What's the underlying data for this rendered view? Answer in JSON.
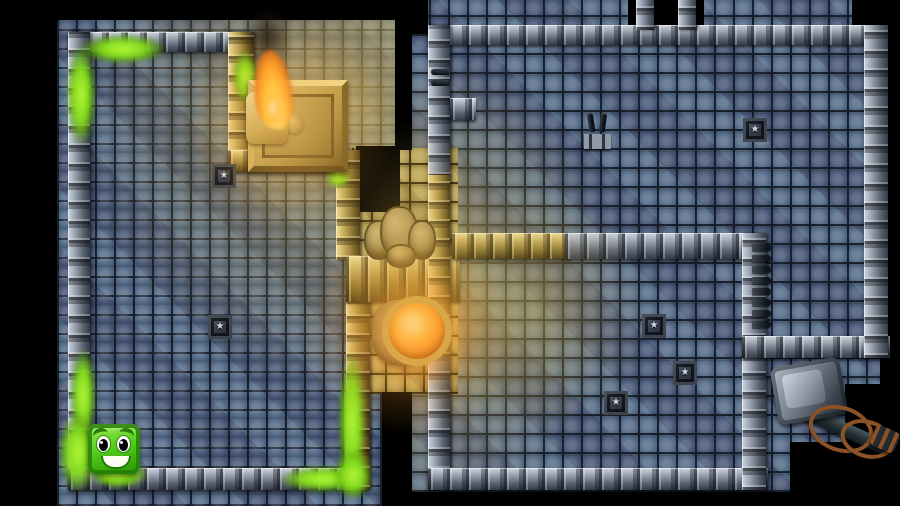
{
  "app": {
    "name": "Top-down dungeon puzzle game",
    "view": "level overview"
  },
  "entities": {
    "player": {
      "name": "Green slime cube hero",
      "color": "#4ec81a",
      "expression": "smiling"
    },
    "torch": {
      "name": "Lit torch on golden pedestal",
      "flame_color": "#ff9a22",
      "smoke": true
    },
    "beacon": {
      "name": "Glowing orange orb beacon",
      "color": "#ff8f1f",
      "ring_color": "#c2a452"
    },
    "rocks": {
      "name": "Boulder pile blocking corridor",
      "count": 4,
      "color": "#a48d54"
    },
    "hammer": {
      "name": "Giant sledgehammer with rope-bound handle",
      "head_color": "#77818d",
      "rope_color": "#8a5226"
    },
    "plates": {
      "name": "Star pressure plate",
      "glyph": "★",
      "count": 6,
      "color": "#3a4150"
    },
    "hook_traps": {
      "name": "Twin metal hook trap",
      "count": 2
    },
    "hook_row": {
      "name": "Row of wall hook pegs",
      "count": 8
    },
    "slime_trail": {
      "name": "Green slime trail",
      "color": "#84dc1e",
      "segments": 11
    }
  },
  "rooms": [
    {
      "id": "left",
      "floor_color": "#516282",
      "lighting": "warm glow from torch at top-right"
    },
    {
      "id": "right",
      "floor_color": "#516282",
      "lighting": "warm glow from corridor at left"
    },
    {
      "id": "corridor",
      "floor_color": "#a3934f",
      "lighting": "fully lit gold"
    }
  ],
  "palette": {
    "void": "#000000",
    "floor_blue": "#516282",
    "floor_gold": "#a3934f",
    "wall_gray": "#a7b0bd",
    "wall_gold": "#cdb76b",
    "glow": "#ffb347",
    "slime": "#84dc1e"
  }
}
